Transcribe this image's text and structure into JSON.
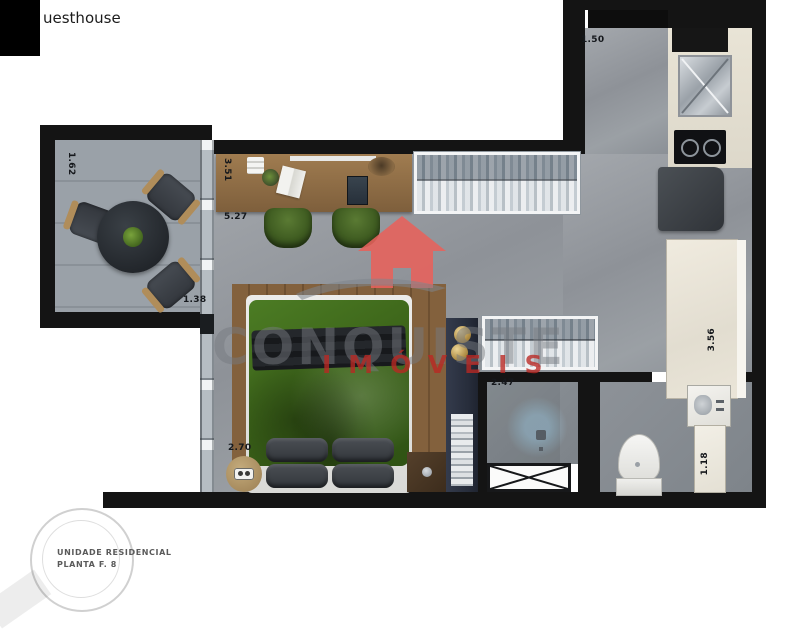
{
  "header": {
    "title_fragment": "uesthouse"
  },
  "watermark": {
    "brand": "CONQUISTE",
    "subbrand": "IMÓVEIS",
    "house_color": "#e8625c",
    "brand_color": "#767a7f",
    "subbrand_color": "#ba2823"
  },
  "floorplan": {
    "dimensions": {
      "entry": "1.50",
      "balcony_width": "1.62",
      "balcony_depth": "1.38",
      "desk_wall": "3.51",
      "room_length": "5.27",
      "bed_width": "2.70",
      "closet_area": "2.47",
      "kitchen_counter": "3.56",
      "bath_counter": "1.18"
    },
    "colors": {
      "wall": "#141414",
      "floor": "#949aa0",
      "counter": "#ece7db",
      "duvet_green": "#3f6b1c",
      "wood": "#8a6b45",
      "shelf_navy": "#2b3140"
    }
  },
  "stamp": {
    "line1": "UNIDADE RESIDENCIAL",
    "line2": "PLANTA F. 8"
  }
}
